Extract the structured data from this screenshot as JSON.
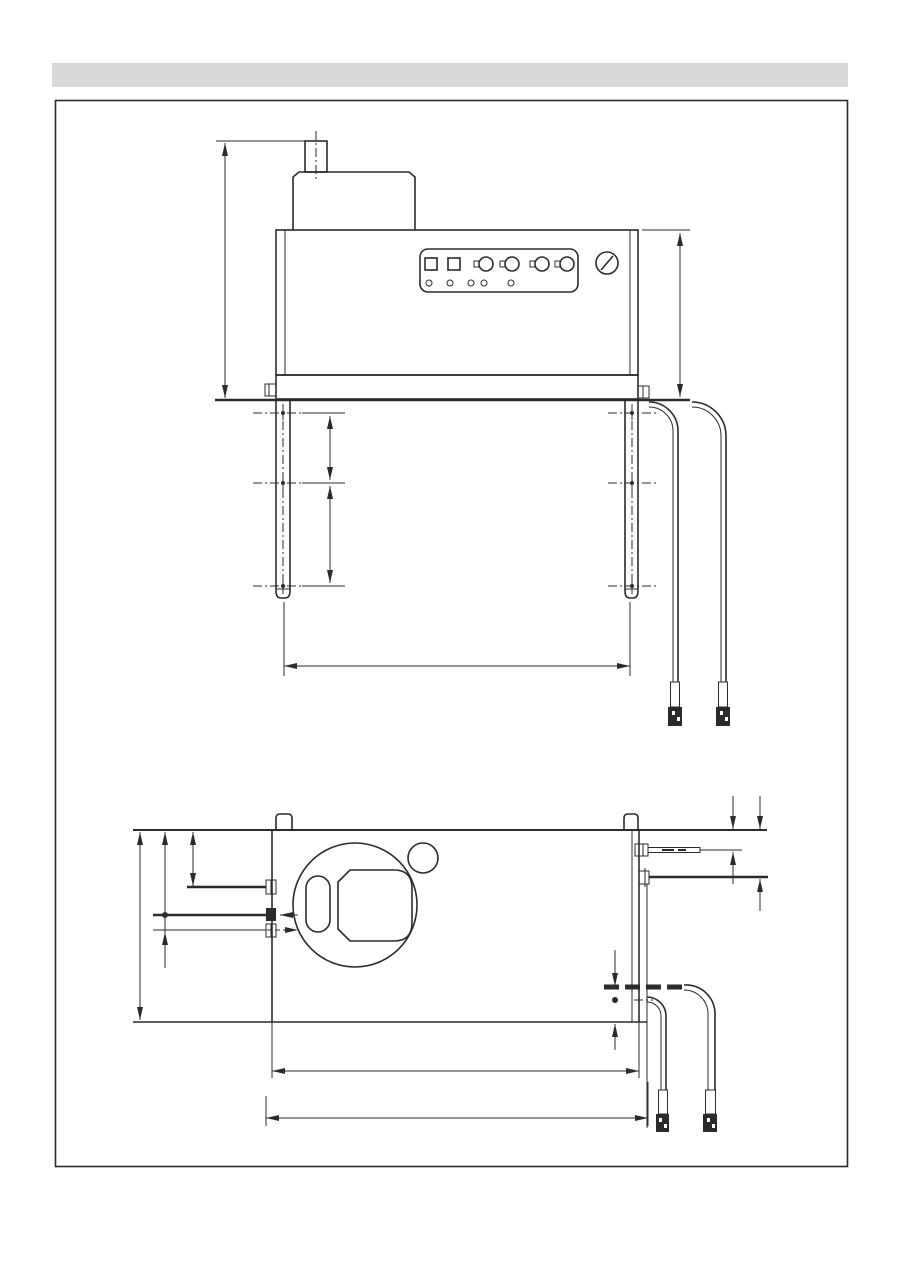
{
  "page": {
    "background_color": "#ffffff",
    "header_bar_color": "#d8d8d8",
    "line_color": "#2b2b2b",
    "frame_border_color": "#2b2b2b",
    "visible_text": []
  },
  "drawing": {
    "kind": "appliance dimensional line drawing, unlabeled dimension lines, no text",
    "views": [
      {
        "id": "front-elevation",
        "elements": {
          "flue_pipe": 1,
          "flue_collar": 1,
          "body": 1,
          "control_panel": {
            "square_buttons": 2,
            "rotary_knobs": 4,
            "indicator_lights": 5
          },
          "round_gauge": 1,
          "legs": 2,
          "center_marks_per_leg": 3,
          "side_fittings": 2,
          "hoses": 2,
          "hose_connectors": 2
        },
        "dimensions": {
          "vertical": [
            "overall-height-left",
            "body-height-right",
            "leg-mark-spacing-upper",
            "leg-mark-spacing-lower"
          ],
          "horizontal": [
            "leg-centerline-span"
          ]
        }
      },
      {
        "id": "plan-view",
        "elements": {
          "outline": 1,
          "top_tabs": 2,
          "burner_ring": 1,
          "burner_inner_opening": 1,
          "burner_slot": 1,
          "small_port_circle": 1,
          "left_connection_fittings": 3,
          "right_screw": 1,
          "right_fitting": 1,
          "hoses": 2,
          "hose_connectors": 2
        },
        "dimensions": {
          "vertical": [
            "overall-depth",
            "left-connection-offset-a",
            "left-connection-offset-b",
            "left-connection-offset-c",
            "right-screw-offset",
            "right-fitting-offset",
            "hose-offset-chain"
          ],
          "horizontal": [
            "body-width",
            "overall-width-with-connections"
          ]
        }
      }
    ]
  }
}
